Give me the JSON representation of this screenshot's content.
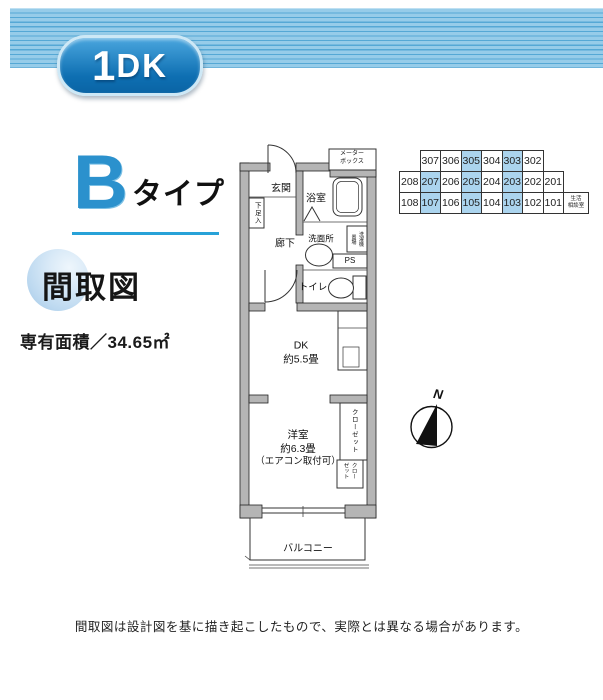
{
  "colors": {
    "banner_base": "#96cce9",
    "banner_stripe": "#55a8d5",
    "badge_light": "#4aa6de",
    "badge_dark": "#0e6fb2",
    "badge_border": "#cde8f6",
    "heading_blue": "#2b91cd",
    "underline_blue": "#28a2d8",
    "ball_blue": "#bdd9f0",
    "highlight_cell": "#abd4ee",
    "wall_gray": "#b5b5b5"
  },
  "banner": {
    "unit_type_big": "1",
    "unit_type_rest": "DK"
  },
  "heading": {
    "type_letter": "B",
    "type_suffix": "タイプ"
  },
  "plan_badge": {
    "label": "間取図"
  },
  "area": {
    "label": "専有面積／34.65㎡"
  },
  "room_grid": {
    "rows": [
      {
        "indent": 1,
        "cells": [
          {
            "label": "307"
          },
          {
            "label": "306"
          },
          {
            "label": "305",
            "hl": true
          },
          {
            "label": "304"
          },
          {
            "label": "303",
            "hl": true
          },
          {
            "label": "302"
          }
        ]
      },
      {
        "indent": 0,
        "cells": [
          {
            "label": "208"
          },
          {
            "label": "207",
            "hl": true
          },
          {
            "label": "206"
          },
          {
            "label": "205",
            "hl": true
          },
          {
            "label": "204"
          },
          {
            "label": "203",
            "hl": true
          },
          {
            "label": "202"
          },
          {
            "label": "201"
          }
        ]
      },
      {
        "indent": 0,
        "cells": [
          {
            "label": "108"
          },
          {
            "label": "107",
            "hl": true
          },
          {
            "label": "106"
          },
          {
            "label": "105",
            "hl": true
          },
          {
            "label": "104"
          },
          {
            "label": "103",
            "hl": true
          },
          {
            "label": "102"
          },
          {
            "label": "101"
          },
          {
            "label": "生活\n相談室",
            "small": true
          }
        ]
      }
    ]
  },
  "plan": {
    "rooms": {
      "entrance": "玄関",
      "shoe_box": "下足入",
      "bathroom": "浴室",
      "corridor": "廊下",
      "washroom": "洗面所",
      "laundry_line1": "洗濯機",
      "laundry_line2": "置場",
      "pipe_space": "PS",
      "toilet": "トイレ",
      "meter_line1": "メーター",
      "meter_line2": "ボックス",
      "dk_line1": "DK",
      "dk_line2": "約5.5畳",
      "bedroom_line1": "洋室",
      "bedroom_line2": "約6.3畳",
      "bedroom_line3": "（エアコン取付可）",
      "closet_tall": "クローゼット",
      "closet_small_line1": "クロー",
      "closet_small_line2": "ゼット",
      "balcony": "バルコニー"
    },
    "compass": {
      "label": "N"
    }
  },
  "footer": {
    "disclaimer": "間取図は設計図を基に描き起こしたもので、実際とは異なる場合があります。"
  }
}
